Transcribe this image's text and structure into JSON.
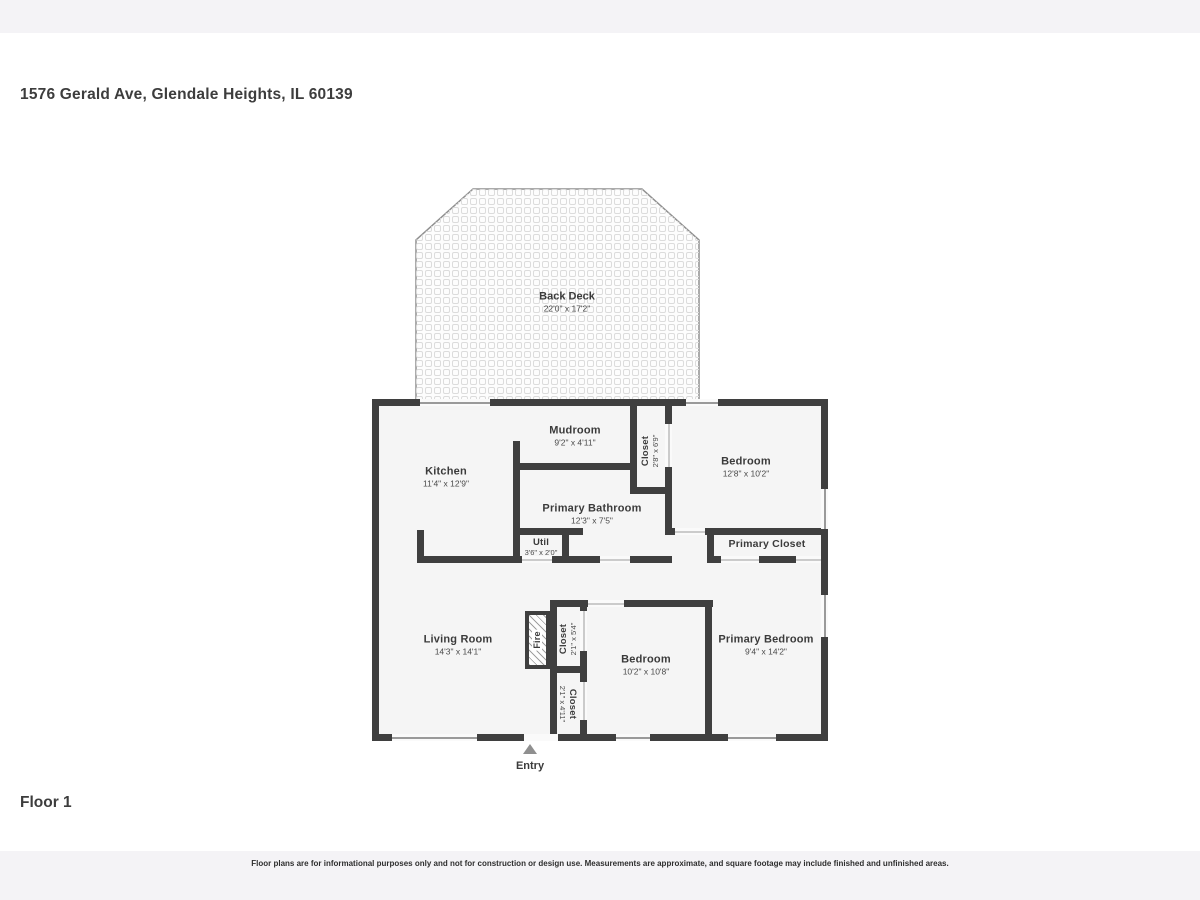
{
  "page": {
    "address": "1576 Gerald Ave, Glendale Heights, IL 60139",
    "floor_label": "Floor 1",
    "entry_label": "Entry",
    "disclaimer": "Floor plans are for informational purposes only and not for construction or design use. Measurements are approximate, and square footage may include finished and unfinished areas."
  },
  "rooms": {
    "back_deck": {
      "name": "Back Deck",
      "dims": "22'0\" x 17'2\""
    },
    "mudroom": {
      "name": "Mudroom",
      "dims": "9'2\" x 4'11\""
    },
    "mud_closet": {
      "name": "Closet",
      "dims": "2'8\" x 6'9\""
    },
    "bedroom_top": {
      "name": "Bedroom",
      "dims": "12'8\" x 10'2\""
    },
    "kitchen": {
      "name": "Kitchen",
      "dims": "11'4\" x 12'9\""
    },
    "primary_bathroom": {
      "name": "Primary Bathroom",
      "dims": "12'3\" x 7'5\""
    },
    "util": {
      "name": "Util",
      "dims": "3'6\" x 2'0\""
    },
    "primary_closet": {
      "name": "Primary Closet"
    },
    "living_room": {
      "name": "Living Room",
      "dims": "14'3\" x 14'1\""
    },
    "fire": {
      "name": "Fire"
    },
    "closet_mid": {
      "name": "Closet",
      "dims": "2'1\" x 5'4\""
    },
    "bedroom_mid": {
      "name": "Bedroom",
      "dims": "10'2\" x 10'8\""
    },
    "closet_bottom": {
      "name": "Closet",
      "dims": "2'1\" x 4'11\""
    },
    "primary_bedroom": {
      "name": "Primary Bedroom",
      "dims": "9'4\" x 14'2\""
    }
  },
  "colors": {
    "wall": "#3f3f3f",
    "room_fill": "#f5f5f5",
    "page_background": "#f4f3f6",
    "content_background": "#ffffff",
    "window_line": "#9a9a9a"
  }
}
